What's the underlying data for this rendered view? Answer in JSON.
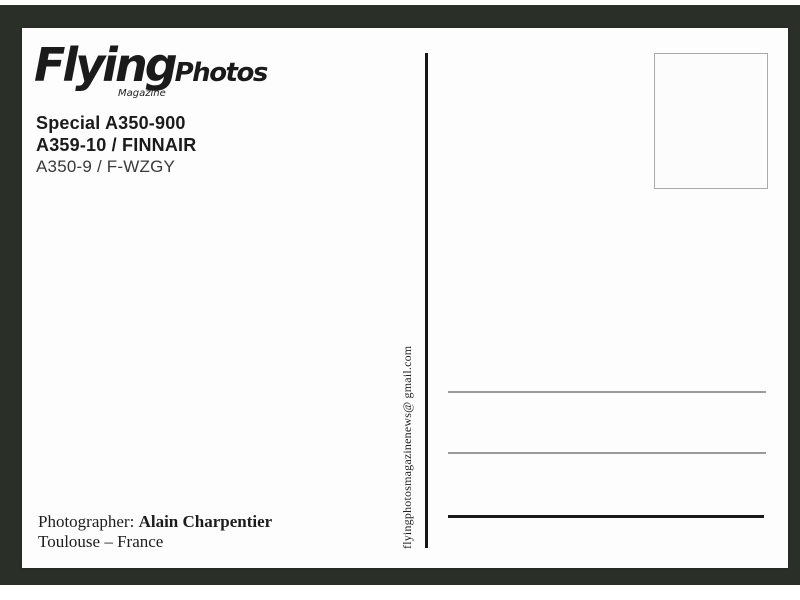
{
  "logo": {
    "brand": "Flying",
    "suffix": "Photos",
    "tagline": "Magazine"
  },
  "heading": {
    "special": "Special A350-900",
    "aircraft": "A359-10 / FINNAIR",
    "registration": "A350-9 / F-WZGY"
  },
  "email_vertical": "flyingphotosmagazinenews@ gmail.com",
  "credits": {
    "photographer_label": "Photographer:",
    "photographer_name": "Alain Charpentier",
    "location": "Toulouse – France"
  },
  "colors": {
    "frame": "#2a2f28",
    "card": "#fdfdfd",
    "ink": "#1b1b1b",
    "divider": "#151515",
    "address_line_gray": "#9b9b9b",
    "address_line_black": "#1a1a1a",
    "stamp_border": "#aaaaaa"
  }
}
